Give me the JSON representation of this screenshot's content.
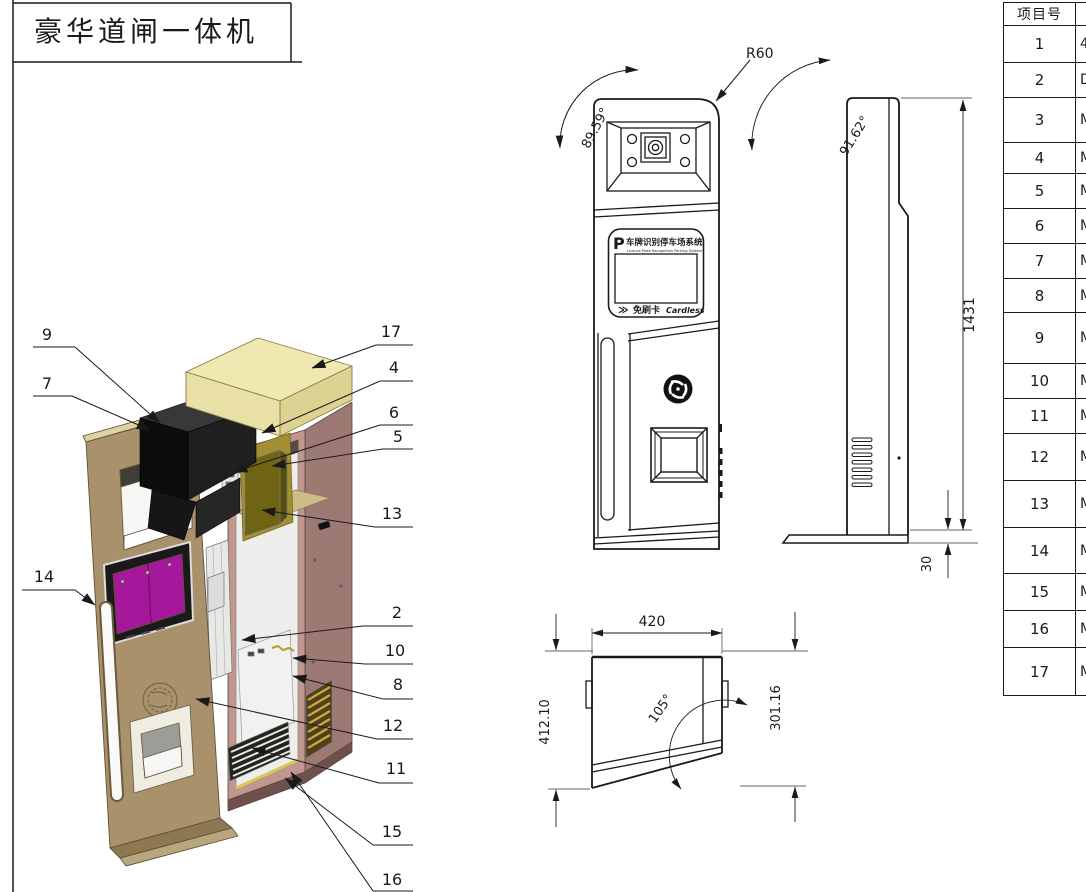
{
  "title_block": {
    "title": "豪华道闸一体机"
  },
  "callouts": [
    "9",
    "7",
    "14",
    "17",
    "4",
    "6",
    "5",
    "13",
    "2",
    "10",
    "8",
    "12",
    "11",
    "15",
    "16"
  ],
  "front_view": {
    "brand_p": "P",
    "brand_cn": "车牌识别停车场系统",
    "brand_en": "Licence Plate Recognition Parking System",
    "cardless_arrows": "≫",
    "cardless_cn": "免刷卡",
    "cardless_en": "Cardless",
    "dim_radius": "R60",
    "dim_angle": "89.59°"
  },
  "side_view": {
    "dim_angle": "91.62°",
    "dim_height": "1431",
    "dim_base": "30"
  },
  "top_view": {
    "dim_width": "420",
    "dim_depth": "412.10",
    "dim_front_depth": "301.16",
    "dim_angle": "105°"
  },
  "parts_table": {
    "header_col1": "项目号",
    "rows": [
      {
        "no": "1",
        "part": "4"
      },
      {
        "no": "2",
        "part": "D"
      },
      {
        "no": "3",
        "part": "M"
      },
      {
        "no": "4",
        "part": "M"
      },
      {
        "no": "5",
        "part": "M"
      },
      {
        "no": "6",
        "part": "M"
      },
      {
        "no": "7",
        "part": "M"
      },
      {
        "no": "8",
        "part": "M"
      },
      {
        "no": "9",
        "part": "M"
      },
      {
        "no": "10",
        "part": "M"
      },
      {
        "no": "11",
        "part": "M"
      },
      {
        "no": "12",
        "part": "M"
      },
      {
        "no": "13",
        "part": "M"
      },
      {
        "no": "14",
        "part": "M"
      },
      {
        "no": "15",
        "part": "M"
      },
      {
        "no": "16",
        "part": "M"
      },
      {
        "no": "17",
        "part": "M"
      }
    ]
  },
  "colors": {
    "line": "#1a1a1a",
    "top_cap": "#efe9b1",
    "cabinet_side": "#9d7973",
    "cabinet_front": "#c0978f",
    "door": "#a8916b",
    "screen": "#a5179b",
    "psu": "#6e6414",
    "gold_trim": "#d8c94f"
  }
}
